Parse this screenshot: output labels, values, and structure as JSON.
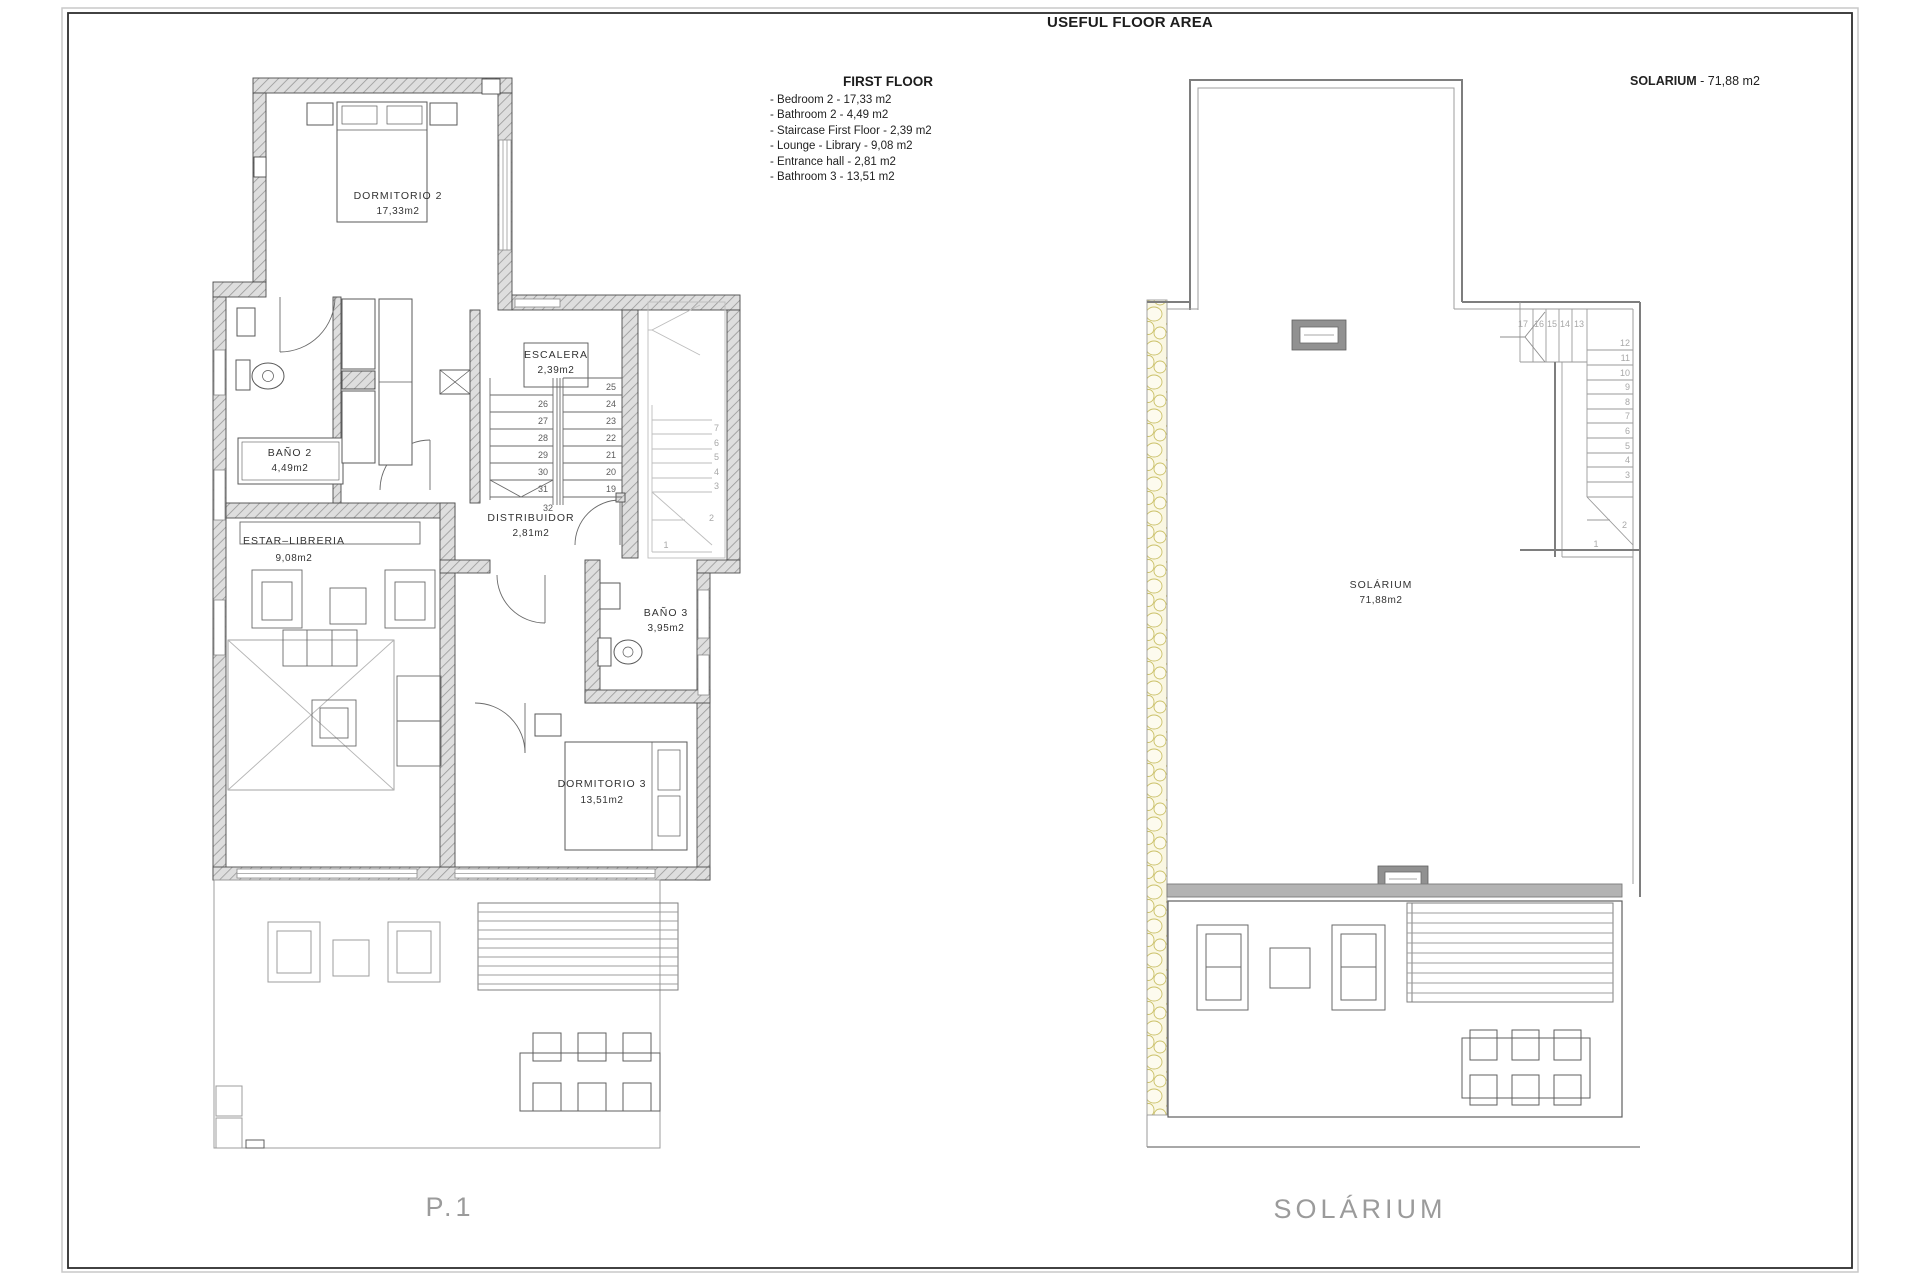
{
  "title": "USEFUL FLOOR AREA",
  "legend": {
    "heading": "FIRST FLOOR",
    "items": [
      "- Bedroom 2 - 17,33 m2",
      "- Bathroom 2 - 4,49 m2",
      "- Staircase First Floor - 2,39 m2",
      "- Lounge - Library - 9,08 m2",
      "- Entrance hall - 2,81 m2",
      "- Bathroom 3 - 13,51 m2"
    ]
  },
  "solarium_header": {
    "label": "SOLARIUM",
    "value": " - 71,88 m2"
  },
  "plan1": {
    "caption": "P.1",
    "rooms": {
      "dormitorio2": {
        "name": "DORMITORIO 2",
        "area": "17,33m2"
      },
      "bano2": {
        "name": "BAÑO 2",
        "area": "4,49m2"
      },
      "escalera": {
        "name": "ESCALERA",
        "area": "2,39m2"
      },
      "estar": {
        "name": "ESTAR–LIBRERIA",
        "area": "9,08m2"
      },
      "distribuidor": {
        "name": "DISTRIBUIDOR",
        "area": "2,81m2"
      },
      "bano3": {
        "name": "BAÑO 3",
        "area": "3,95m2"
      },
      "dormitorio3": {
        "name": "DORMITORIO 3",
        "area": "13,51m2"
      }
    },
    "stairs": {
      "left_col": [
        "26",
        "27",
        "28",
        "29",
        "30",
        "31"
      ],
      "right_col": [
        "25",
        "24",
        "23",
        "22",
        "21",
        "20",
        "19"
      ],
      "landing": "32",
      "ghost": [
        "7",
        "6",
        "5",
        "4",
        "3"
      ],
      "ghost2": "2",
      "ghost1": "1"
    }
  },
  "plan2": {
    "caption": "SOLÁRIUM",
    "room": {
      "name": "SOLÁRIUM",
      "area": "71,88m2"
    },
    "stairs": {
      "top_row": [
        "17",
        "16",
        "15",
        "14",
        "13"
      ],
      "col": [
        "12",
        "11",
        "10",
        "9",
        "8",
        "7",
        "6",
        "5",
        "4",
        "3"
      ],
      "n2": "2",
      "n1": "1"
    }
  }
}
